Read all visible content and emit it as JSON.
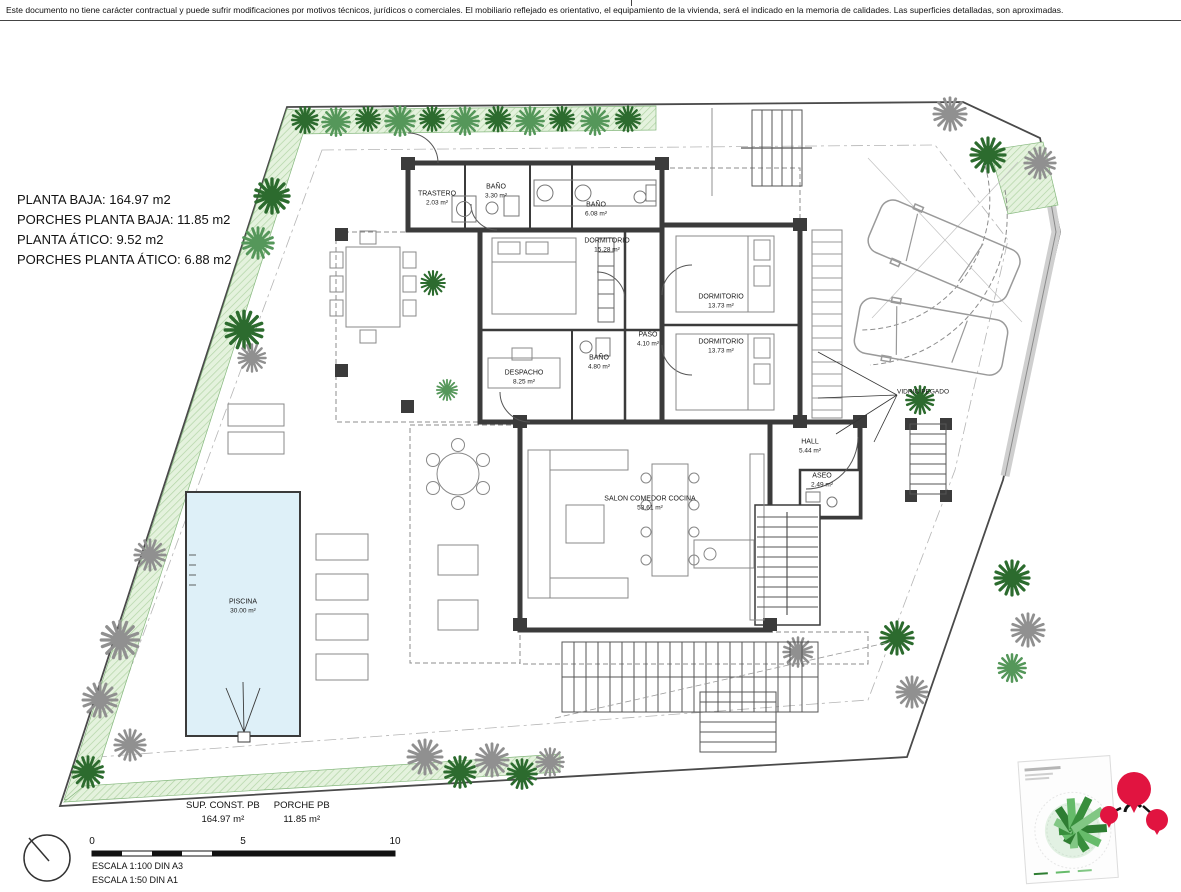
{
  "disclaimer": "Este documento no tiene carácter contractual y puede sufrir modificaciones por motivos técnicos, jurídicos o comerciales. El mobiliario reflejado es orientativo, el equipamiento de la vivienda, será el indicado en la memoria de calidades. Las superficies detalladas, son aproximadas.",
  "summary": {
    "planta_baja": "PLANTA BAJA: 164.97 m2",
    "porches_planta_baja": "PORCHES PLANTA BAJA: 11.85 m2",
    "planta_atico": "PLANTA ÁTICO: 9.52 m2",
    "porches_planta_atico": "PORCHES PLANTA ÁTICO: 6.88 m2"
  },
  "rooms": {
    "trastero": {
      "name": "TRASTERO",
      "area": "2.03 m²"
    },
    "bano_330": {
      "name": "BAÑO",
      "area": "3.30 m²"
    },
    "bano_608": {
      "name": "BAÑO",
      "area": "6.08 m²"
    },
    "dormitorio1": {
      "name": "DORMITORIO",
      "area": "15.28 m²"
    },
    "dormitorio2": {
      "name": "DORMITORIO",
      "area": "13.73 m²"
    },
    "dormitorio3": {
      "name": "DORMITORIO",
      "area": "13.73 m²"
    },
    "paso": {
      "name": "PASO",
      "area": "4.10 m²"
    },
    "despacho": {
      "name": "DESPACHO",
      "area": "8.25 m²"
    },
    "bano_480": {
      "name": "BAÑO",
      "area": "4.80 m²"
    },
    "hall": {
      "name": "HALL",
      "area": "5.44 m²"
    },
    "aseo": {
      "name": "ASEO",
      "area": "2.49 m²"
    },
    "salon": {
      "name": "SALON COMEDOR COCINA",
      "area": "53.61 m²"
    },
    "piscina": {
      "name": "PISCINA",
      "area": "30.00 m²"
    }
  },
  "annotations": {
    "vidrio_pegado": "VIDRIO PEGADO"
  },
  "totals": {
    "sup_const_label": "SUP. CONST. PB",
    "sup_const_value": "164.97 m²",
    "porche_label": "PORCHE PB",
    "porche_value": "11.85 m²"
  },
  "scale": {
    "tick0": "0",
    "tick5": "5",
    "tick10": "10",
    "line1": "ESCALA 1:100 DIN A3",
    "line2": "ESCALA 1:50 DIN A1"
  },
  "colors": {
    "wall": "#3b3b3b",
    "vegetation_fill": "#e4f2dd",
    "vegetation_line": "#b2d4a6",
    "palm_green_dark": "#2c6b2e",
    "palm_green_light": "#55975a",
    "palm_gray": "#909090",
    "pool_fill": "#def0f8",
    "logo_red": "#e11440",
    "rose_green": "#2e7d32"
  }
}
